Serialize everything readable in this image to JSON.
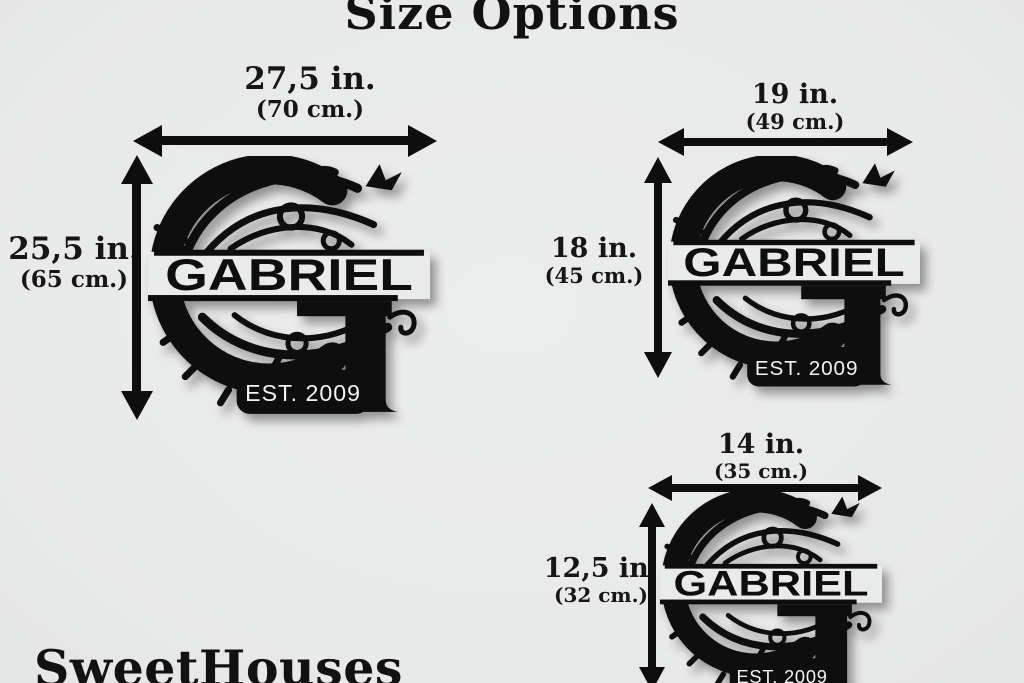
{
  "page": {
    "title": "Size Options",
    "brand": "SweetHouses",
    "colors": {
      "background": "#e9eaea",
      "ink": "#0e0e0e",
      "badge_text": "#f2f2f2"
    }
  },
  "sign": {
    "name": "GABRIEL",
    "est": "EST. 2009"
  },
  "sizes": [
    {
      "label": "large",
      "width_in": "27,5 in.",
      "width_cm": "(70 cm.)",
      "height_in": "25,5 in.",
      "height_cm": "(65 cm.)"
    },
    {
      "label": "medium",
      "width_in": "19 in.",
      "width_cm": "(49 cm.)",
      "height_in": "18 in.",
      "height_cm": "(45 cm.)"
    },
    {
      "label": "small",
      "width_in": "14 in.",
      "width_cm": "(35 cm.)",
      "height_in": "12,5 in.",
      "height_cm": "(32 cm.)"
    }
  ]
}
